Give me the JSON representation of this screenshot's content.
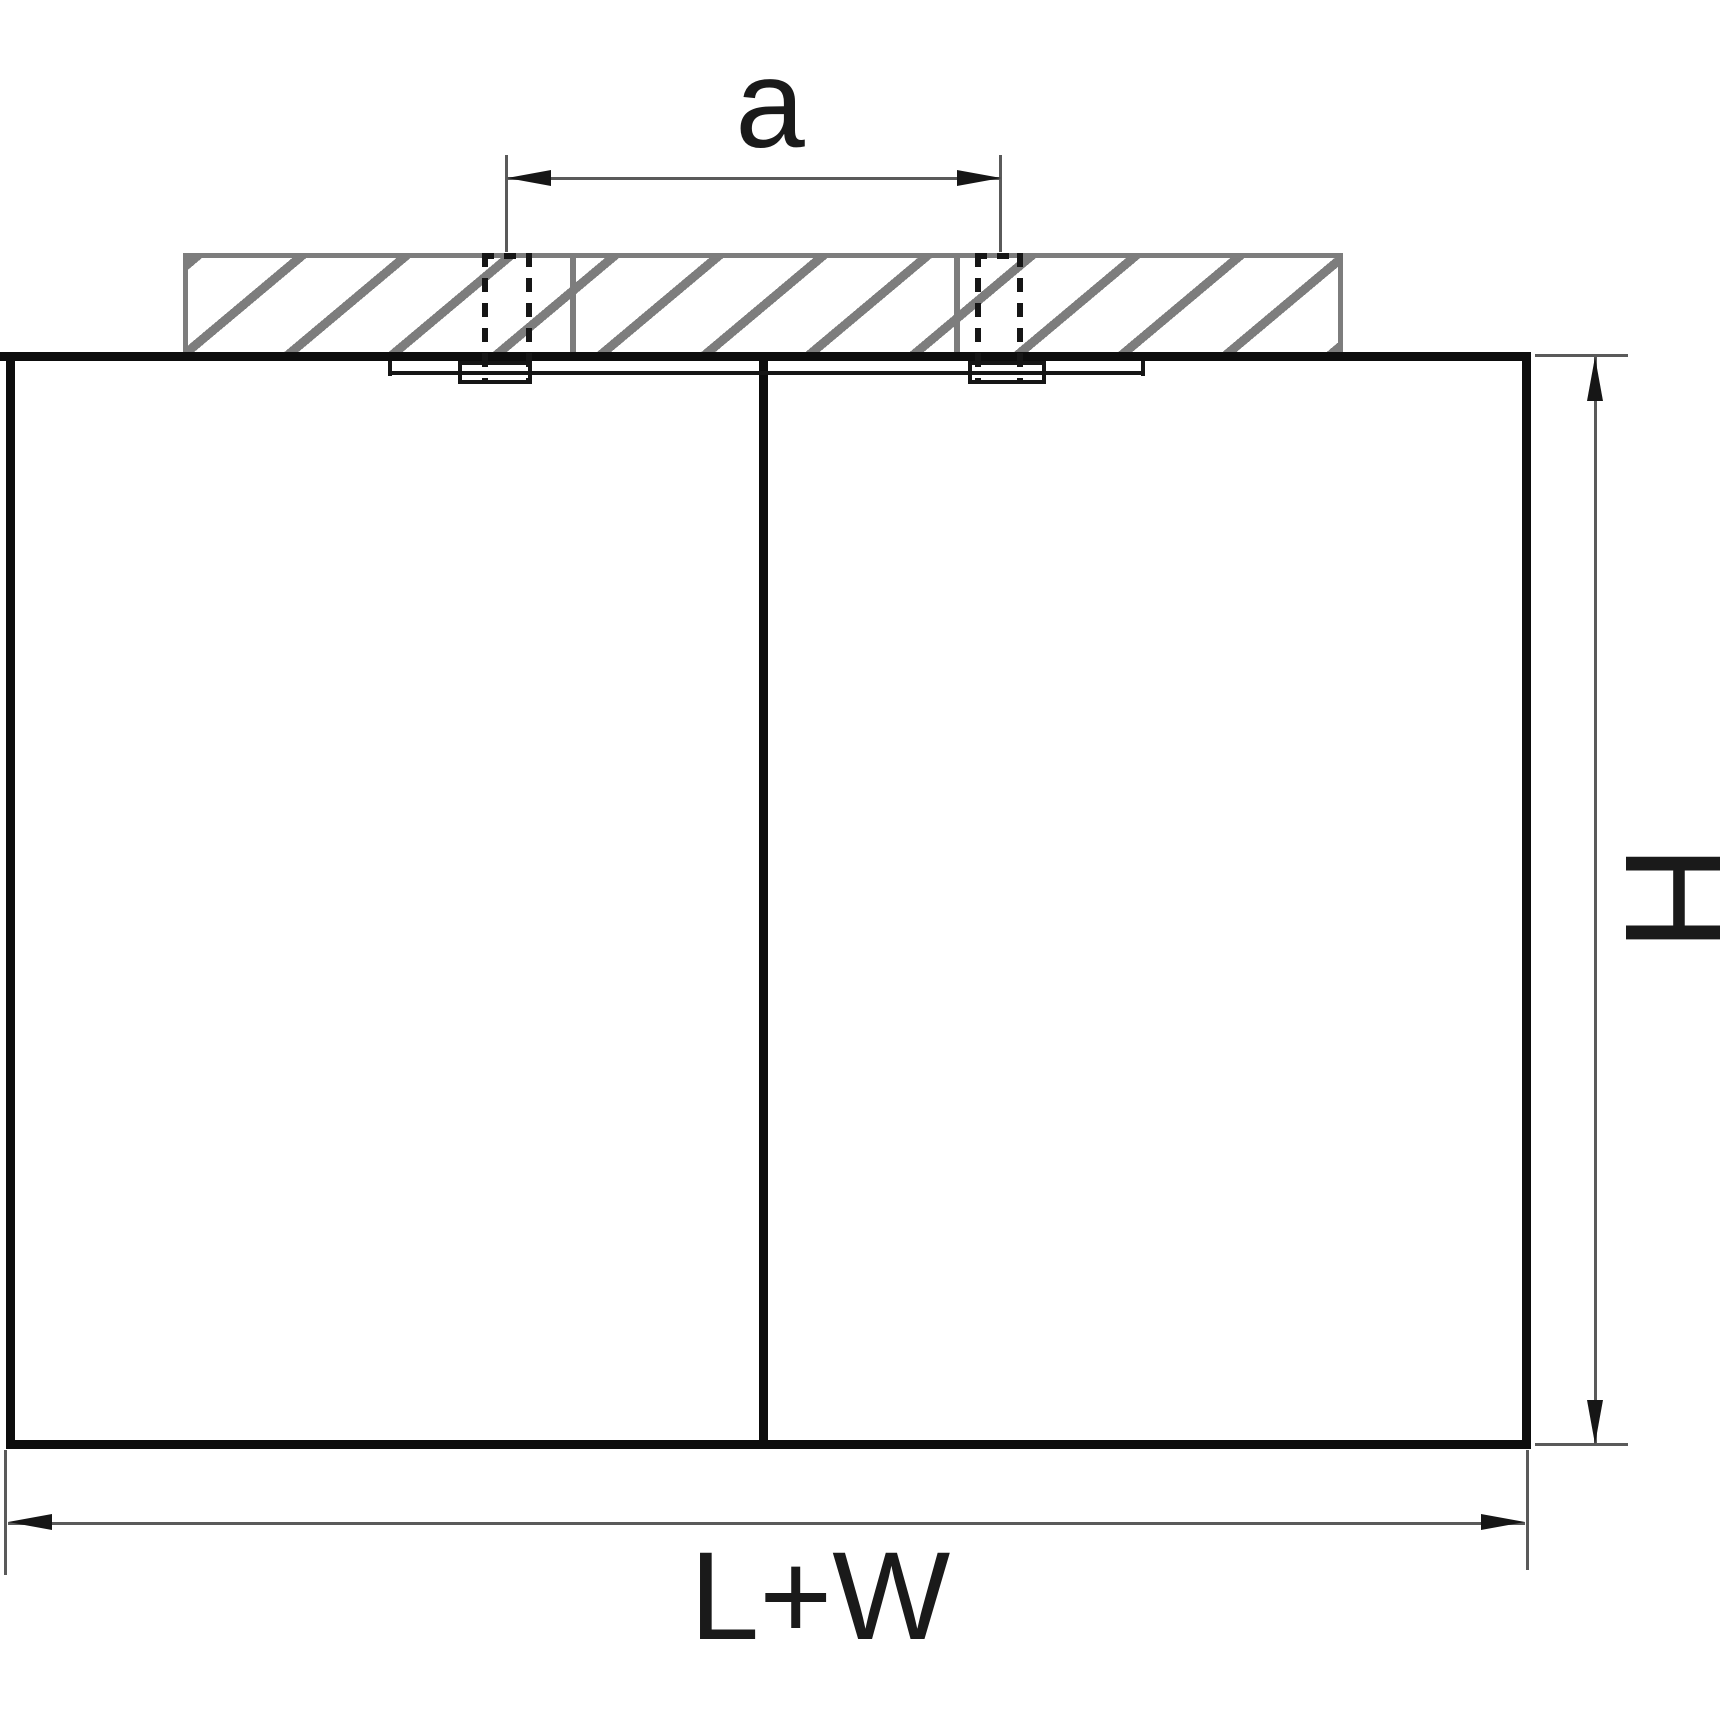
{
  "diagram": {
    "labels": {
      "hole_spacing": "a",
      "height": "H",
      "width_total": "L+W"
    },
    "colors": {
      "background": "#ffffff",
      "ceiling_hatch": "#7d7d7d",
      "fixture_outline": "#0d0d0d",
      "dimension_line": "#5a5a5a",
      "arrowhead": "#161616",
      "label_text": "#1a1a1a"
    }
  }
}
